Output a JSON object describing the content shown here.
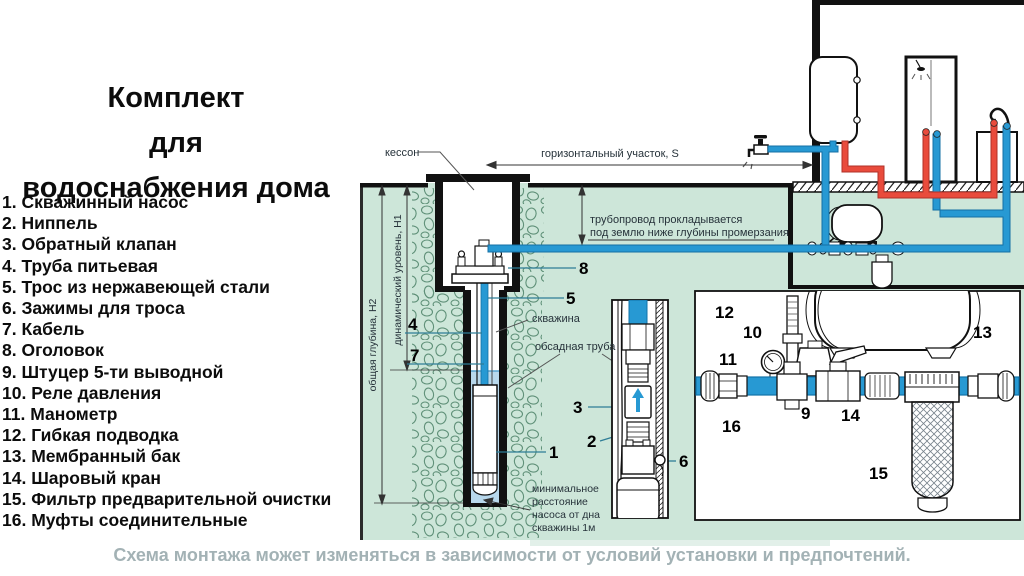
{
  "title": {
    "line1": "Комплект",
    "line2": "для",
    "line3": "водоснабжения дома"
  },
  "parts_list": {
    "items": [
      "1. Скважинный насос",
      "2. Ниппель",
      "3. Обратный клапан",
      "4. Труба питьевая",
      "5. Трос из нержавеющей стали",
      "6. Зажимы для троса",
      "7. Кабель",
      "8. Оголовок",
      "9. Штуцер 5-ти выводной",
      "10. Реле давления",
      "11. Манометр",
      "12. Гибкая подводка",
      "13. Мембранный бак",
      "14. Шаровый кран",
      "15. Фильтр предварительной очистки",
      "16. Муфты соединительные"
    ]
  },
  "footer": {
    "caption": "Схема монтажа может изменяться в зависимости от условий установки и предпочтений."
  },
  "diagram": {
    "labels": {
      "kesson": "кессон",
      "horizontal_section": "горизонтальный участок, S",
      "pipeline_note_line1": "трубопровод прокладывается",
      "pipeline_note_line2": "под землю ниже глубины промерзания",
      "well": "скважина",
      "casing_pipe": "обсадная труба",
      "total_depth": "общая глубина, Н2",
      "dynamic_level": "динамический уровень, Н1",
      "min_distance_line1": "минимальное",
      "min_distance_line2": "расстояние",
      "min_distance_line3": "насоса от дна",
      "min_distance_line4": "скважины 1м"
    },
    "callouts": {
      "n1": "1",
      "n2": "2",
      "n3": "3",
      "n4": "4",
      "n5": "5",
      "n6": "6",
      "n7": "7",
      "n8": "8",
      "n9": "9",
      "n10": "10",
      "n11": "11",
      "n12": "12",
      "n13": "13",
      "n14": "14",
      "n15": "15",
      "n16": "16"
    },
    "colors": {
      "ground": "#cde6d9",
      "cold_pipe": "#2799d3",
      "hot_pipe": "#e94b3c",
      "leader": "#2e7d96",
      "stones": "#5f9078",
      "water": "#b8d8ec",
      "caption": "#a3b2b5"
    }
  }
}
